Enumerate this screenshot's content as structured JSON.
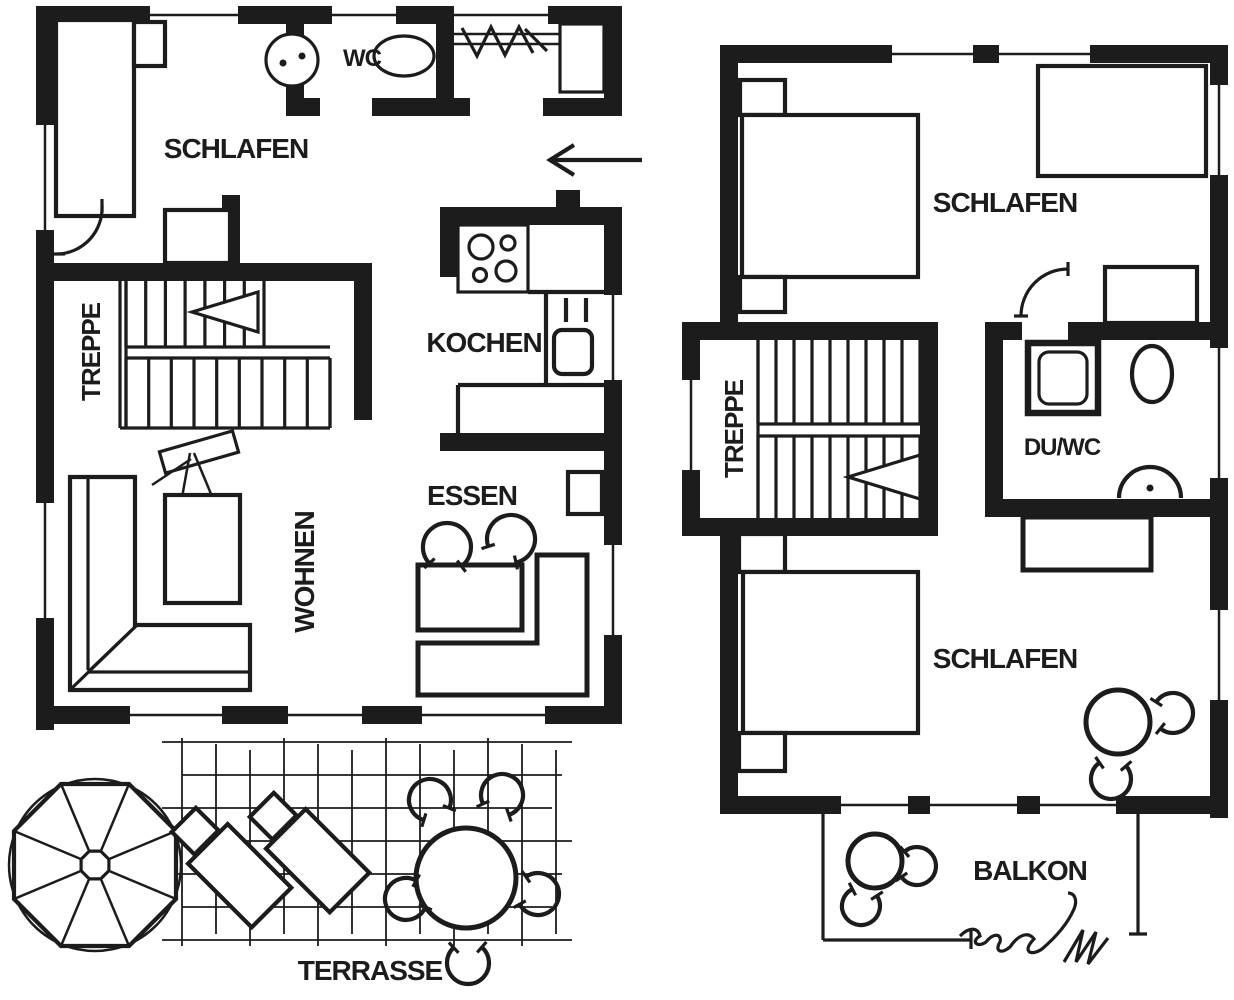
{
  "document": {
    "type": "floor-plan",
    "language": "de"
  },
  "colors": {
    "ink": "#1c1c1c",
    "paper": "#ffffff"
  },
  "floors": {
    "ground": {
      "rooms": {
        "schlafen": "SCHLAFEN",
        "wc": "WC",
        "treppe": "TREPPE",
        "kochen": "KOCHEN",
        "essen": "ESSEN",
        "wohnen": "WOHNEN"
      },
      "outdoor": {
        "terrasse": "TERRASSE"
      }
    },
    "upper": {
      "rooms": {
        "schlafen_top": "SCHLAFEN",
        "treppe": "TREPPE",
        "du_wc": "DU/WC",
        "schlafen_bottom": "SCHLAFEN"
      },
      "outdoor": {
        "balkon": "BALKON"
      }
    }
  }
}
